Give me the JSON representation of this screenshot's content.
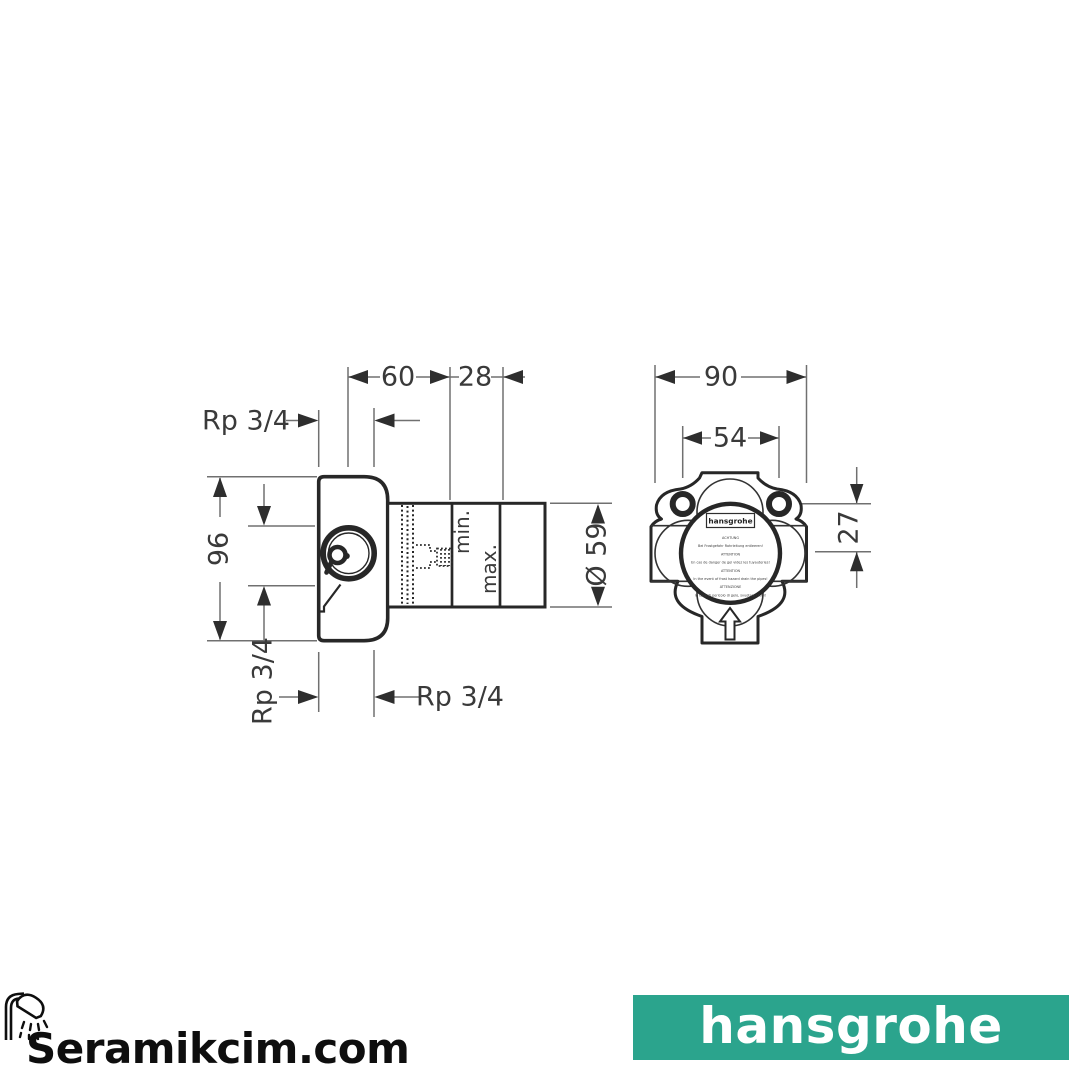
{
  "drawing": {
    "side_view": {
      "dim_top_width": "60",
      "dim_top_depth": "28",
      "dim_top_thread": "Rp 3/4",
      "dim_height": "96",
      "dim_side_thread": "Rp 3/4",
      "dim_bottom_thread": "Rp 3/4",
      "label_min": "min.",
      "label_max": "max.",
      "dim_diameter": "Ø 59"
    },
    "front_view": {
      "dim_overall_width": "90",
      "dim_hole_spacing": "54",
      "dim_center_offset": "27",
      "label": {
        "brand": "hansgrohe",
        "lines": [
          "ACHTUNG",
          "Bei Frostgefahr Rohrleitung entleeren!",
          "ATTENTION",
          "En cas de danger de gel videz les tuyauteries!",
          "ATTENTION",
          "In the event of frost hazard drain the pipes!",
          "ATTENZIONE",
          "In caso di pericolo di gelo, svuotare i tubi!"
        ]
      }
    },
    "line_color": "#272727"
  },
  "footer": {
    "store_logo": {
      "text": "Seramikcim.com",
      "icon": "shower-head-icon",
      "color": "#0e0e0e"
    },
    "brand_banner": {
      "text": "hansgrohe",
      "background": "#2BA48D",
      "text_color": "#ffffff"
    }
  }
}
